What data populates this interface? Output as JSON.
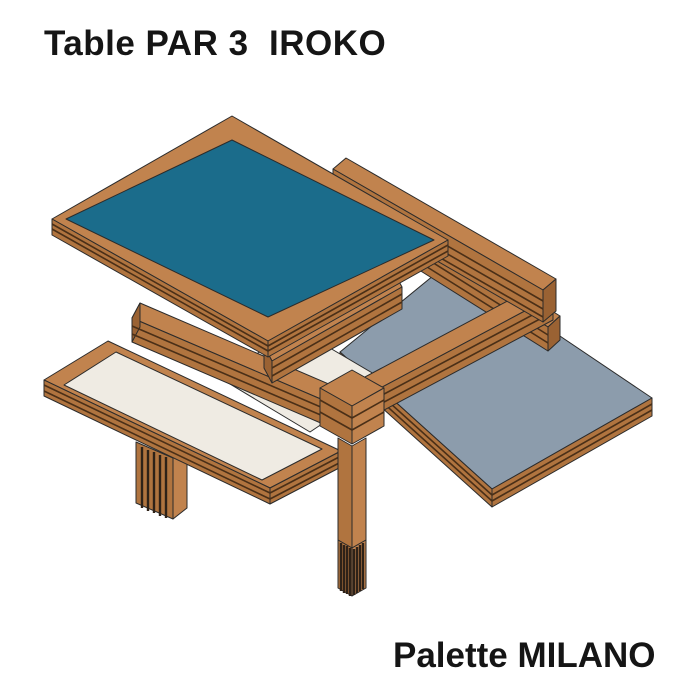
{
  "page": {
    "background": "#ffffff"
  },
  "title": {
    "text": "Table PAR 3  IROKO"
  },
  "caption": {
    "text": "Palette MILANO"
  },
  "illustration": {
    "description": "Isometric technical drawing of a table with three pivoting tops (teal, cream, grey) on a timber cross-frame with central striped-foot leg",
    "palette": {
      "wood_top": "#C1834E",
      "wood_side": "#B0743F",
      "wood_end": "#9A6233",
      "wood_line": "#4a2f17",
      "outline": "#2b2b2b",
      "teal_panel": "#1B6C8B",
      "cream_panel": "#EFEBE3",
      "gray_panel": "#8C9CAC",
      "stripe": "#2e2218",
      "background": "#ffffff"
    },
    "parts": [
      "gray-top",
      "left-leg",
      "cream-top",
      "small-cream-panel",
      "rail-front-left",
      "rail-back-left",
      "rail-back-right",
      "rail-front-right",
      "center-joint",
      "center-leg",
      "top-rail",
      "teal-top"
    ]
  }
}
